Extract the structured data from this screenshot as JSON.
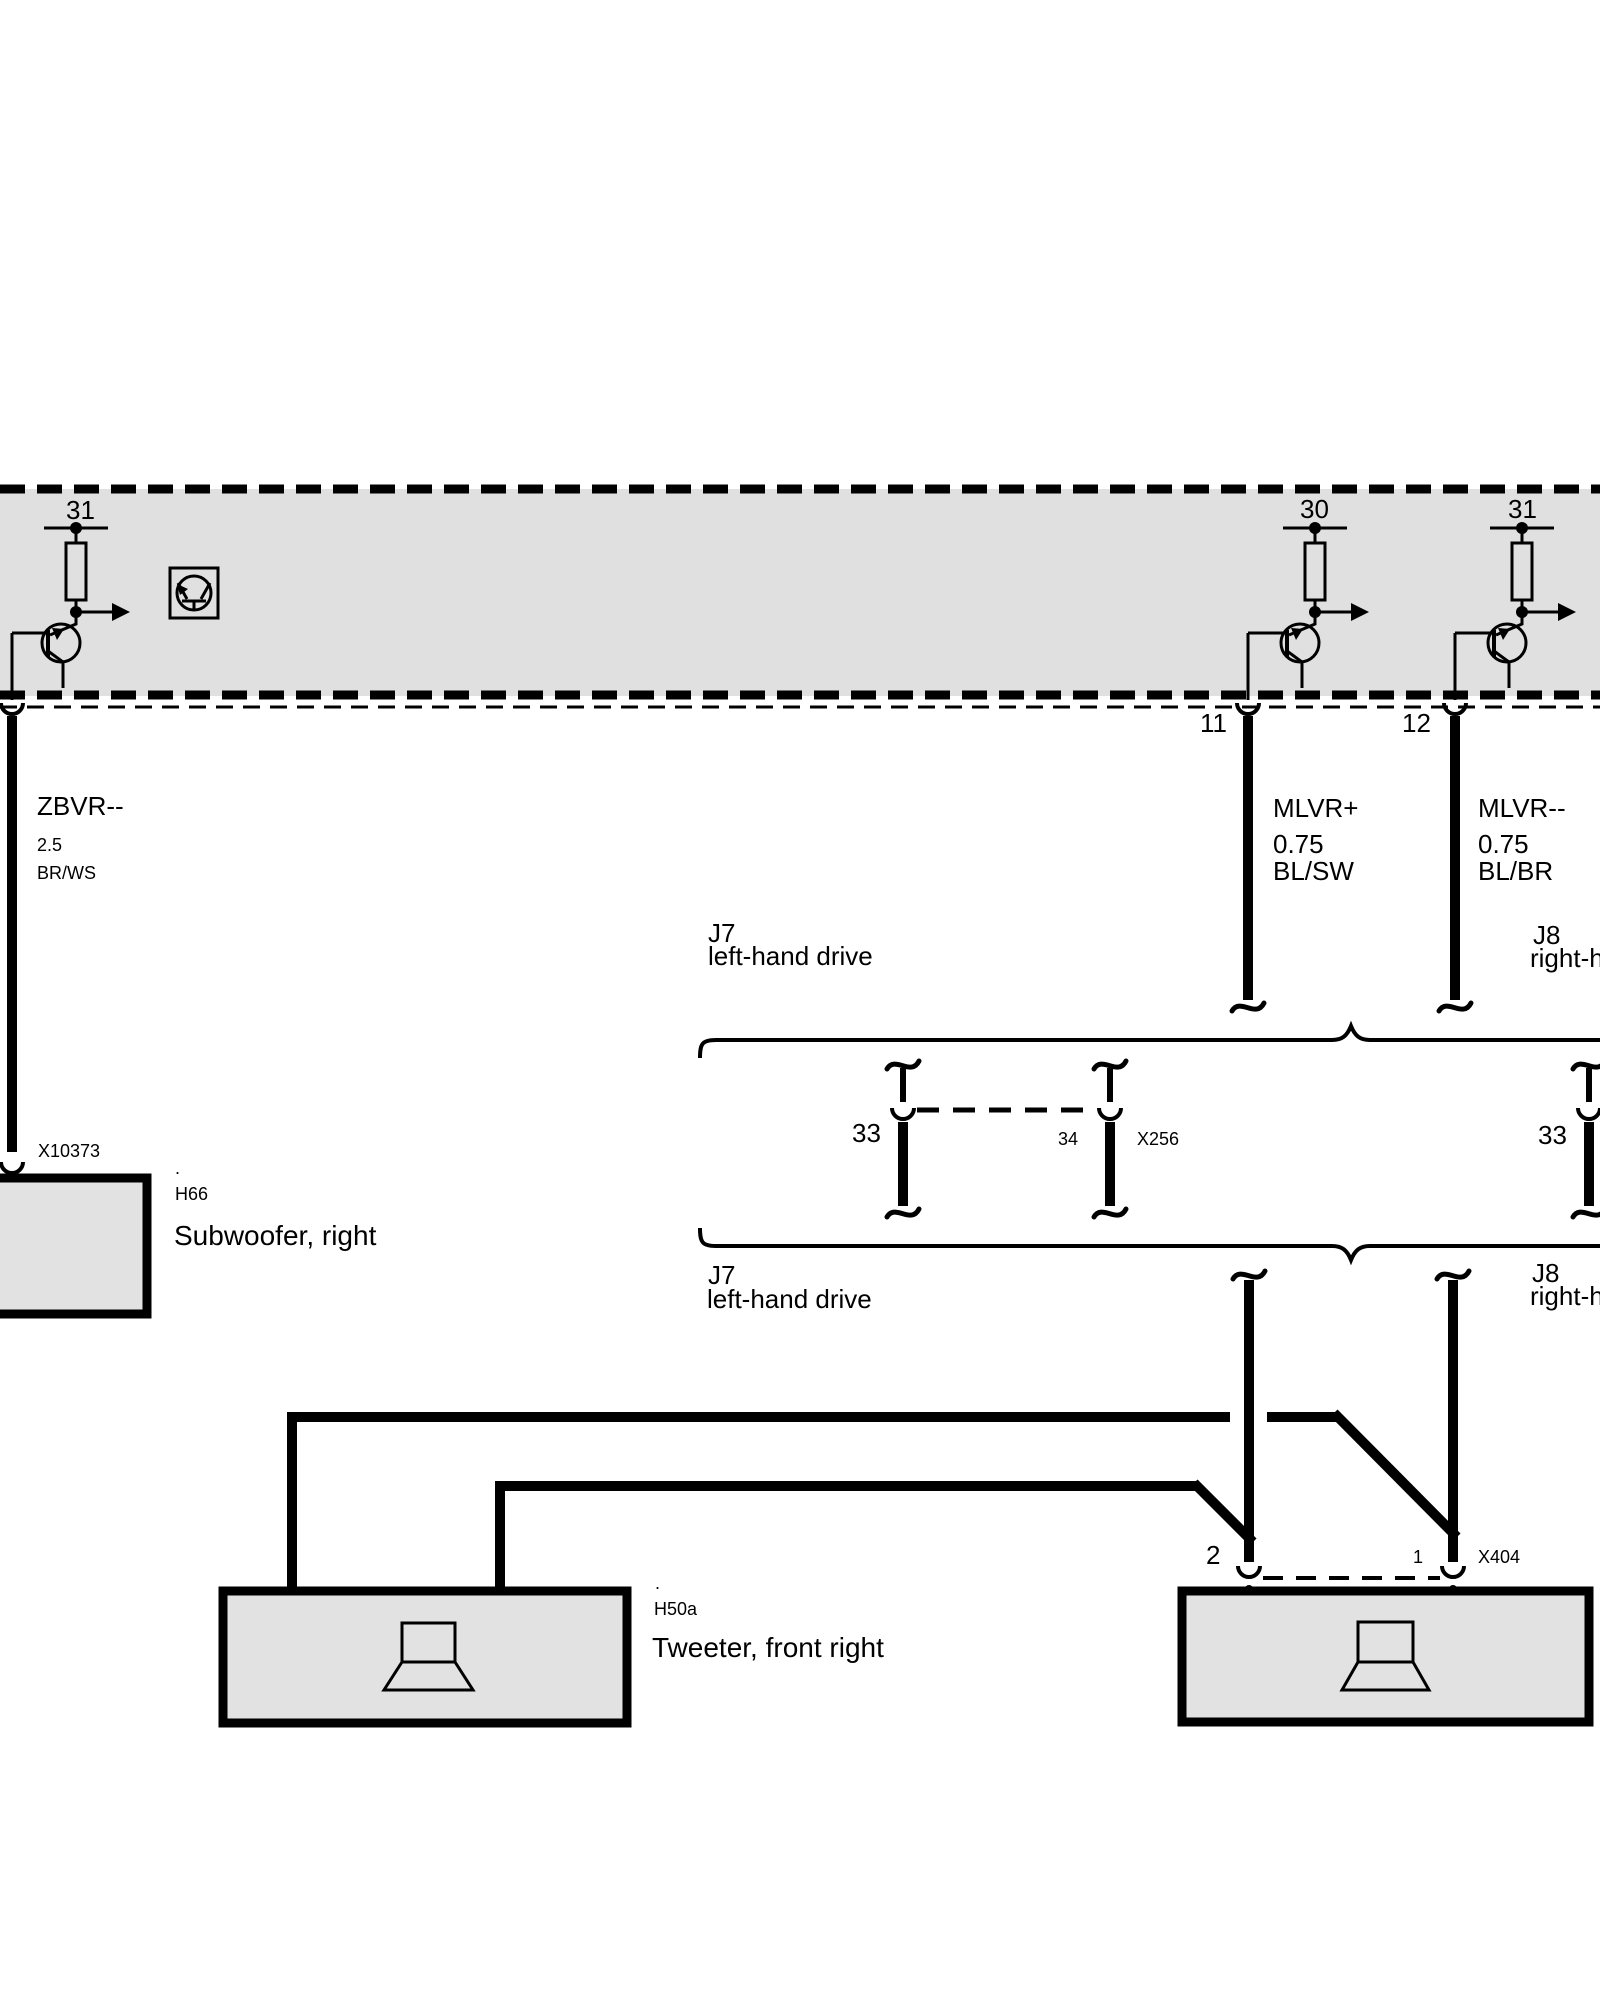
{
  "module": {
    "terminal_31_left": "31",
    "terminal_30": "30",
    "terminal_31_right": "31",
    "pin_11": "11",
    "pin_12": "12"
  },
  "wires": {
    "zbvr": {
      "name": "ZBVR--",
      "gauge": "2.5",
      "color_code": "BR/WS"
    },
    "mlvr_plus": {
      "name": "MLVR+",
      "gauge": "0.75",
      "color_code": "BL/SW"
    },
    "mlvr_minus": {
      "name": "MLVR--",
      "gauge": "0.75",
      "color_code": "BL/BR"
    }
  },
  "variants": {
    "top_left_code": "J7",
    "top_left_name": "left-hand drive",
    "top_right_code": "J8",
    "top_right_name": "right-h",
    "bottom_left_code": "J7",
    "bottom_left_name": "left-hand drive",
    "bottom_right_code": "J8",
    "bottom_right_name": "right-h"
  },
  "connectors": {
    "x256": {
      "name": "X256",
      "pin_left": "33",
      "pin_mid": "34",
      "pin_right_variant": "33"
    },
    "x404": {
      "name": "X404",
      "pin_2": "2",
      "pin_1": "1"
    },
    "x10373": {
      "name": "X10373"
    }
  },
  "components": {
    "subwoofer": {
      "marker": ".",
      "code": "H66",
      "name": "Subwoofer, right"
    },
    "tweeter": {
      "marker": ".",
      "code": "H50a",
      "name": "Tweeter, front right"
    }
  },
  "colors": {
    "line": "#000000",
    "module_fill": "#e0e0e0",
    "component_fill": "#e2e2e2",
    "background": "#ffffff"
  }
}
